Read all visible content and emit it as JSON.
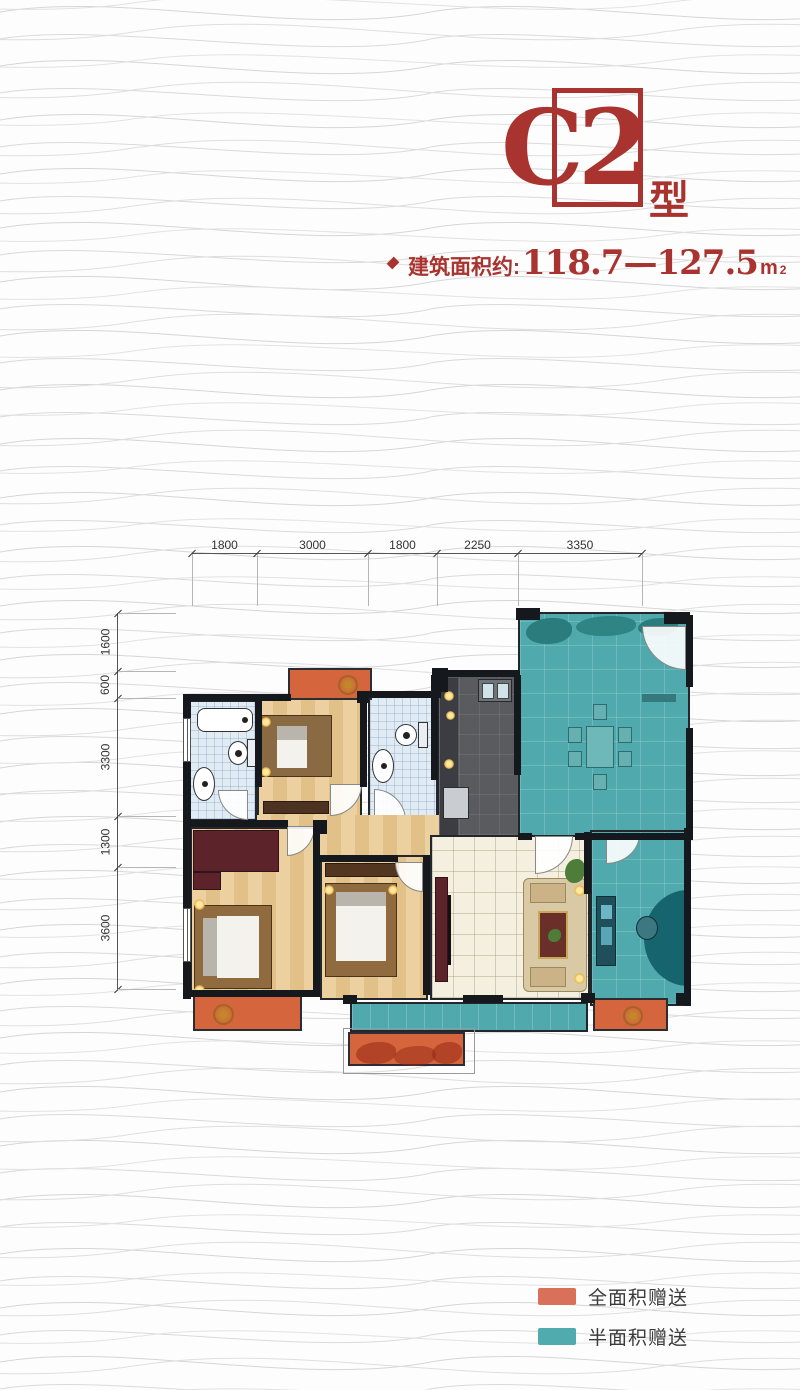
{
  "title": {
    "code": "C2",
    "suffix": "型"
  },
  "area_line": {
    "label": "建筑面积约:",
    "range": "118.7—127.5",
    "unit": "m",
    "unit_sup": "2"
  },
  "dimensions": {
    "top": [
      "1800",
      "3000",
      "1800",
      "2250",
      "3350"
    ],
    "left": [
      "1600",
      "600",
      "3300",
      "1300",
      "3600"
    ]
  },
  "legend": {
    "items": [
      {
        "label": "全面积赠送",
        "color": "#d9705a"
      },
      {
        "label": "半面积赠送",
        "color": "#4fabad"
      }
    ]
  },
  "colors": {
    "accent_red": "#a8332f",
    "gift_full_orange": "#d4653c",
    "gift_half_teal": "#4fa9ad",
    "wall_black": "#15181c",
    "bath_tile_blue": "#e0ebf3",
    "wood_floor": "#e7c893",
    "living_cream": "#f4efde",
    "kitchen_dark": "#5a5b5f"
  }
}
